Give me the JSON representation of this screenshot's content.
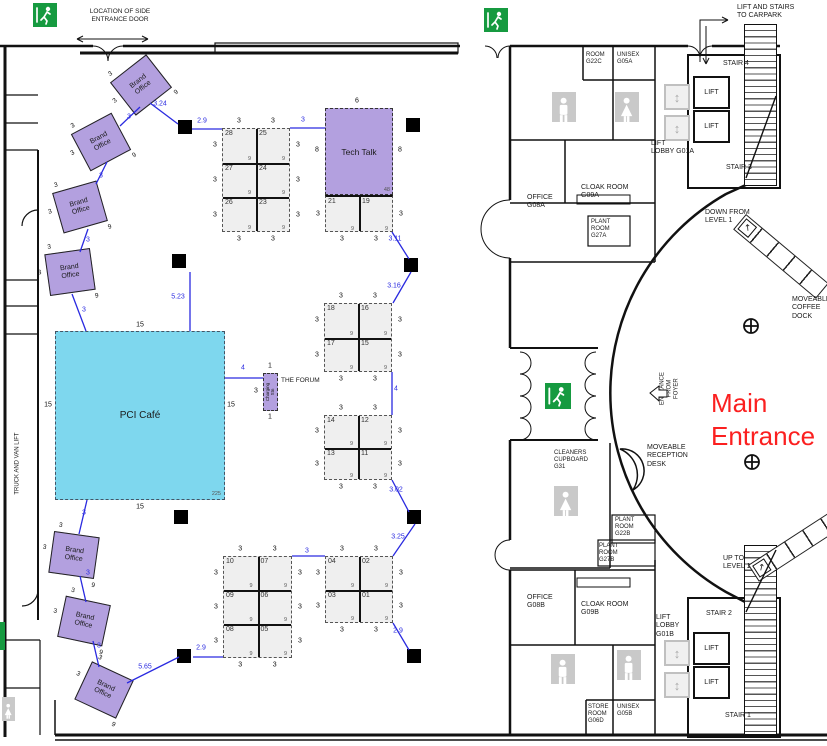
{
  "colors": {
    "purple": "#b3a0df",
    "cyan": "#7ed7ee",
    "dim_blue": "#2a2ae0",
    "exit_green": "#169a40",
    "entrance_red": "#fb2020",
    "booth_fill": "#efefef"
  },
  "icons": {
    "exit": "exit-running-man-icon",
    "male_wc": "male-figure-icon",
    "female_wc": "female-figure-icon",
    "lift_symbol": "lift-cabin-icon",
    "column_marker": "column-grid-marker-icon"
  },
  "labels": {
    "side_entrance": "LOCATION OF SIDE\nENTRANCE DOOR",
    "truck_lift": "TRUCK AND VAN LIFT",
    "carpark": "LIFT AND STAIRS\nTO CARPARK",
    "stair4": "STAIR 4",
    "stair3": "STAIR 3",
    "stair2": "STAIR 2",
    "stair1": "STAIR 1",
    "lift": "LIFT",
    "lift_lobby_a": "LIFT\nLOBBY G01A",
    "lift_lobby_b": "LIFT\nLOBBY\nG01B",
    "room_g22c": "ROOM\nG22C",
    "unisex_a": "UNISEX\nG05A",
    "office_a": "OFFICE\nG08A",
    "cloak_a": "CLOAK ROOM\nG09A",
    "plant_g27a": "PLANT\nROOM\nG27A",
    "down_from": "DOWN FROM\nLEVEL 1",
    "coffee_dock": "MOVEABLE\nCOFFEE\nDOCK",
    "entrance_foyer": "ENTRANCE\nFROM\nFOYER",
    "main_entrance": "Main\nEntrance",
    "reception": "MOVEABLE\nRECEPTION\nDESK",
    "cleaners": "CLEANERS\nCUPBOARD\nG31",
    "plant_g22b": "PLANT\nROOM\nG22B",
    "plant_g27b": "PLANT\nROOM\nG27B",
    "up_to": "UP TO\nLEVEL 1",
    "office_b": "OFFICE\nG08B",
    "cloak_b": "CLOAK ROOM\nG09B",
    "store_g06d": "STORE\nROOM\nG06D",
    "unisex_b": "UNISEX\nG05B",
    "the_forum": "THE FORUM"
  },
  "cafe": {
    "label": "PCI Café",
    "dim": "15",
    "area": "225"
  },
  "tech_talk": {
    "label": "Tech Talk",
    "width_dim": "6",
    "side_dim": "8",
    "area": "48"
  },
  "forum": {
    "unit": "Charging Stn",
    "top": "1",
    "side": "3",
    "bottom": "1",
    "area": "9"
  },
  "brand_offices": {
    "label": "Brand\nOffice",
    "side_dim": "3",
    "area": "9",
    "items": [
      {
        "cx": 141,
        "cy": 85,
        "rot": -38
      },
      {
        "cx": 101,
        "cy": 142,
        "rot": -28
      },
      {
        "cx": 80,
        "cy": 207,
        "rot": -16
      },
      {
        "cx": 70,
        "cy": 272,
        "rot": -8
      },
      {
        "cx": 74,
        "cy": 555,
        "rot": 8
      },
      {
        "cx": 84,
        "cy": 621,
        "rot": 12
      },
      {
        "cx": 104,
        "cy": 690,
        "rot": 25
      }
    ]
  },
  "booths": {
    "side_dim": "3",
    "cell_area": "9",
    "blocks": [
      {
        "x": 222,
        "y": 128,
        "cw": 34,
        "ch": 34.7,
        "rows": [
          [
            "28",
            "25"
          ],
          [
            "27",
            "24"
          ],
          [
            "26",
            "23"
          ]
        ],
        "top": true
      },
      {
        "x": 325,
        "y": 195,
        "cw": 34,
        "ch": 37,
        "rows": [
          [
            "21",
            "19"
          ]
        ],
        "top": false,
        "solid_top": true
      },
      {
        "x": 324,
        "y": 303,
        "cw": 34,
        "ch": 34.5,
        "rows": [
          [
            "18",
            "16"
          ],
          [
            "17",
            "15"
          ]
        ],
        "top": true
      },
      {
        "x": 324,
        "y": 415,
        "cw": 34,
        "ch": 32.5,
        "rows": [
          [
            "14",
            "12"
          ],
          [
            "13",
            "11"
          ]
        ],
        "top": true
      },
      {
        "x": 223,
        "y": 556,
        "cw": 34.5,
        "ch": 34,
        "rows": [
          [
            "10",
            "07"
          ],
          [
            "09",
            "06"
          ],
          [
            "08",
            "05"
          ]
        ],
        "top": true
      },
      {
        "x": 325,
        "y": 556,
        "cw": 34,
        "ch": 33.5,
        "rows": [
          [
            "04",
            "02"
          ],
          [
            "03",
            "01"
          ]
        ],
        "top": true
      }
    ]
  },
  "blue_dims": [
    {
      "x": 160,
      "y": 104,
      "t": "3.24"
    },
    {
      "x": 202,
      "y": 121,
      "t": "2.9"
    },
    {
      "x": 303,
      "y": 120,
      "t": "3"
    },
    {
      "x": 395,
      "y": 239,
      "t": "3.11"
    },
    {
      "x": 394,
      "y": 286,
      "t": "3.16"
    },
    {
      "x": 396,
      "y": 389,
      "t": "4"
    },
    {
      "x": 243,
      "y": 368,
      "t": "4"
    },
    {
      "x": 178,
      "y": 297,
      "t": "5.23"
    },
    {
      "x": 396,
      "y": 490,
      "t": "3.02"
    },
    {
      "x": 398,
      "y": 537,
      "t": "3.25"
    },
    {
      "x": 398,
      "y": 631,
      "t": "2.9"
    },
    {
      "x": 201,
      "y": 648,
      "t": "2.9"
    },
    {
      "x": 145,
      "y": 667,
      "t": "5.65"
    },
    {
      "x": 307,
      "y": 551,
      "t": "3"
    },
    {
      "x": 129,
      "y": 117,
      "t": "3"
    },
    {
      "x": 101,
      "y": 176,
      "t": "3"
    },
    {
      "x": 88,
      "y": 240,
      "t": "3"
    },
    {
      "x": 84,
      "y": 310,
      "t": "3"
    },
    {
      "x": 84,
      "y": 513,
      "t": "3"
    },
    {
      "x": 88,
      "y": 573,
      "t": "3"
    },
    {
      "x": 99,
      "y": 646,
      "t": "3"
    }
  ],
  "blue_lines": [
    [
      150,
      103,
      178,
      124
    ],
    [
      192,
      129,
      222,
      129
    ],
    [
      290,
      128,
      325,
      128
    ],
    [
      392,
      232,
      409,
      259
    ],
    [
      411,
      272,
      393,
      303
    ],
    [
      392,
      372,
      392,
      415
    ],
    [
      225,
      378,
      263,
      378
    ],
    [
      190,
      272,
      190,
      331
    ],
    [
      392,
      480,
      409,
      512
    ],
    [
      415,
      524,
      393,
      556
    ],
    [
      393,
      623,
      409,
      650
    ],
    [
      193,
      657,
      223,
      657
    ],
    [
      127,
      683,
      179,
      657
    ],
    [
      292,
      556,
      325,
      556
    ],
    [
      140,
      107,
      120,
      126
    ],
    [
      107,
      162,
      96,
      184
    ],
    [
      88,
      229,
      80,
      252
    ],
    [
      72,
      294,
      86,
      331
    ],
    [
      87,
      500,
      79,
      534
    ],
    [
      80,
      576,
      86,
      602
    ],
    [
      93,
      641,
      99,
      667
    ]
  ],
  "columns": [
    [
      178,
      120
    ],
    [
      406,
      118
    ],
    [
      172,
      254
    ],
    [
      404,
      258
    ],
    [
      174,
      510
    ],
    [
      407,
      510
    ],
    [
      177,
      649
    ],
    [
      407,
      649
    ]
  ],
  "exits": [
    [
      33,
      3,
      24
    ],
    [
      484,
      8,
      24
    ],
    [
      545,
      383,
      26
    ]
  ],
  "toilets": [
    {
      "x": 552,
      "y": 92,
      "t": "m",
      "w": 24,
      "h": 30
    },
    {
      "x": 615,
      "y": 92,
      "t": "f",
      "w": 24,
      "h": 30
    },
    {
      "x": 554,
      "y": 486,
      "t": "f",
      "w": 24,
      "h": 30
    },
    {
      "x": 551,
      "y": 654,
      "t": "m",
      "w": 24,
      "h": 30
    },
    {
      "x": 617,
      "y": 650,
      "t": "m",
      "w": 24,
      "h": 30
    },
    {
      "x": 2,
      "y": 697,
      "t": "f",
      "w": 13,
      "h": 24
    }
  ]
}
